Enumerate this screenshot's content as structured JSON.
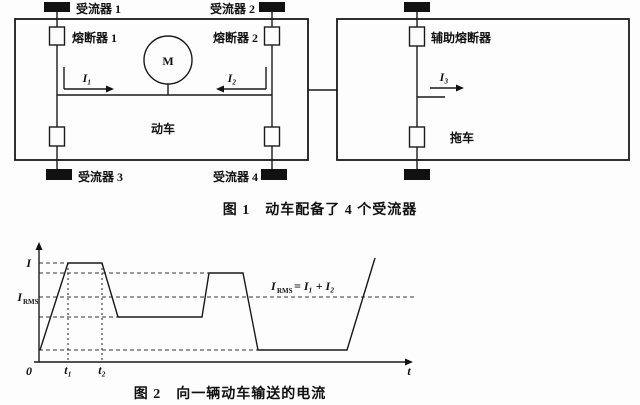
{
  "fig1": {
    "pantograph1": "受流器 1",
    "pantograph2": "受流器 2",
    "pantograph3": "受流器 3",
    "pantograph4": "受流器 4",
    "fuse1": "熔断器 1",
    "fuse2": "熔断器 2",
    "aux_fuse": "辅助熔断器",
    "motor": "M",
    "motor_car": "动车",
    "trailer": "拖车",
    "current1": "I₁",
    "current2": "I₂",
    "current3": "I₃",
    "caption": "图 1　动车配备了 4 个受流器"
  },
  "fig2": {
    "caption": "图 2　向一辆动车输送的电流"
  },
  "chart_data": {
    "type": "line",
    "title": "向一辆动车输送的电流",
    "xlabel": "t",
    "origin_label": "0",
    "ylabel_peak": "I",
    "ylabel_rms_base": "I",
    "ylabel_rms_sub": "RMS",
    "x_ticks": [
      "0",
      "t₁",
      "t₂"
    ],
    "annotation": {
      "base": "I",
      "sub": "RMS",
      "rest": "= I₁ + I₂"
    },
    "axis_px": {
      "x0": 39,
      "y0": 122,
      "x_end": 412,
      "y_top": 6
    },
    "points_px": [
      [
        40,
        110
      ],
      [
        68,
        23
      ],
      [
        102,
        23
      ],
      [
        118,
        77
      ],
      [
        202,
        77
      ],
      [
        209,
        33
      ],
      [
        243,
        33
      ],
      [
        258,
        110
      ],
      [
        347,
        110
      ],
      [
        375,
        18
      ]
    ],
    "reference_levels_px": [
      {
        "name": "peak",
        "y": 23,
        "x_end": 68
      },
      {
        "name": "high",
        "y": 33,
        "x_end": 209
      },
      {
        "name": "rms",
        "y": 57,
        "x_end": 417
      },
      {
        "name": "mid",
        "y": 77,
        "x_end": 118
      },
      {
        "name": "low",
        "y": 110,
        "x_end": 258
      }
    ],
    "time_marks_px": [
      {
        "x": 68,
        "y_top": 23
      },
      {
        "x": 102,
        "y_top": 23
      }
    ],
    "levels_relative": {
      "peak": 1.0,
      "high": 0.9,
      "rms": 0.66,
      "mid": 0.45,
      "low": 0.12
    },
    "legend": "none",
    "grid": "dashed reference lines only"
  }
}
